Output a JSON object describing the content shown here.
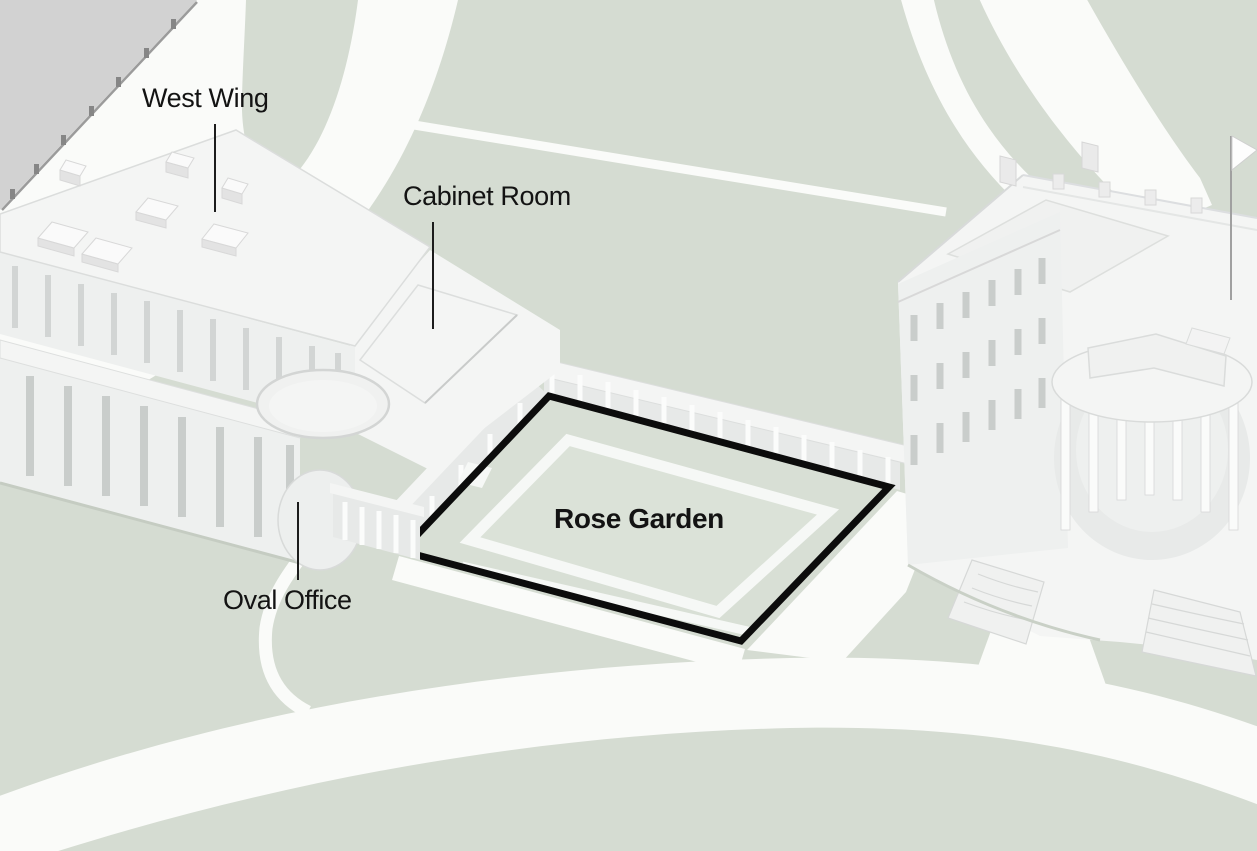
{
  "page": {
    "title": "Map of the White House West Wing and Rose Garden"
  },
  "map": {
    "labels": {
      "west_wing": "West Wing",
      "cabinet_room": "Cabinet Room",
      "oval_office": "Oval Office",
      "rose_garden": "Rose Garden"
    },
    "highlight": {
      "name": "Rose Garden",
      "outline_color": "#0c0c0c"
    },
    "colors": {
      "grass": "#d5dcd2",
      "garden_lawn": "#d8dfd5",
      "garden_lawn_inner": "#dbe2d8",
      "path_white": "#fafbf9",
      "offmap_gray": "#d2d2d2",
      "building_light": "#f4f5f4",
      "building_mid": "#eef0ef",
      "building_shade": "#e7e9e8",
      "detail_line": "#d8dad9",
      "window": "#c9cdcb",
      "outline_black": "#0c0c0c",
      "label_text": "#131313",
      "leader_line": "#1c1c1c"
    }
  }
}
